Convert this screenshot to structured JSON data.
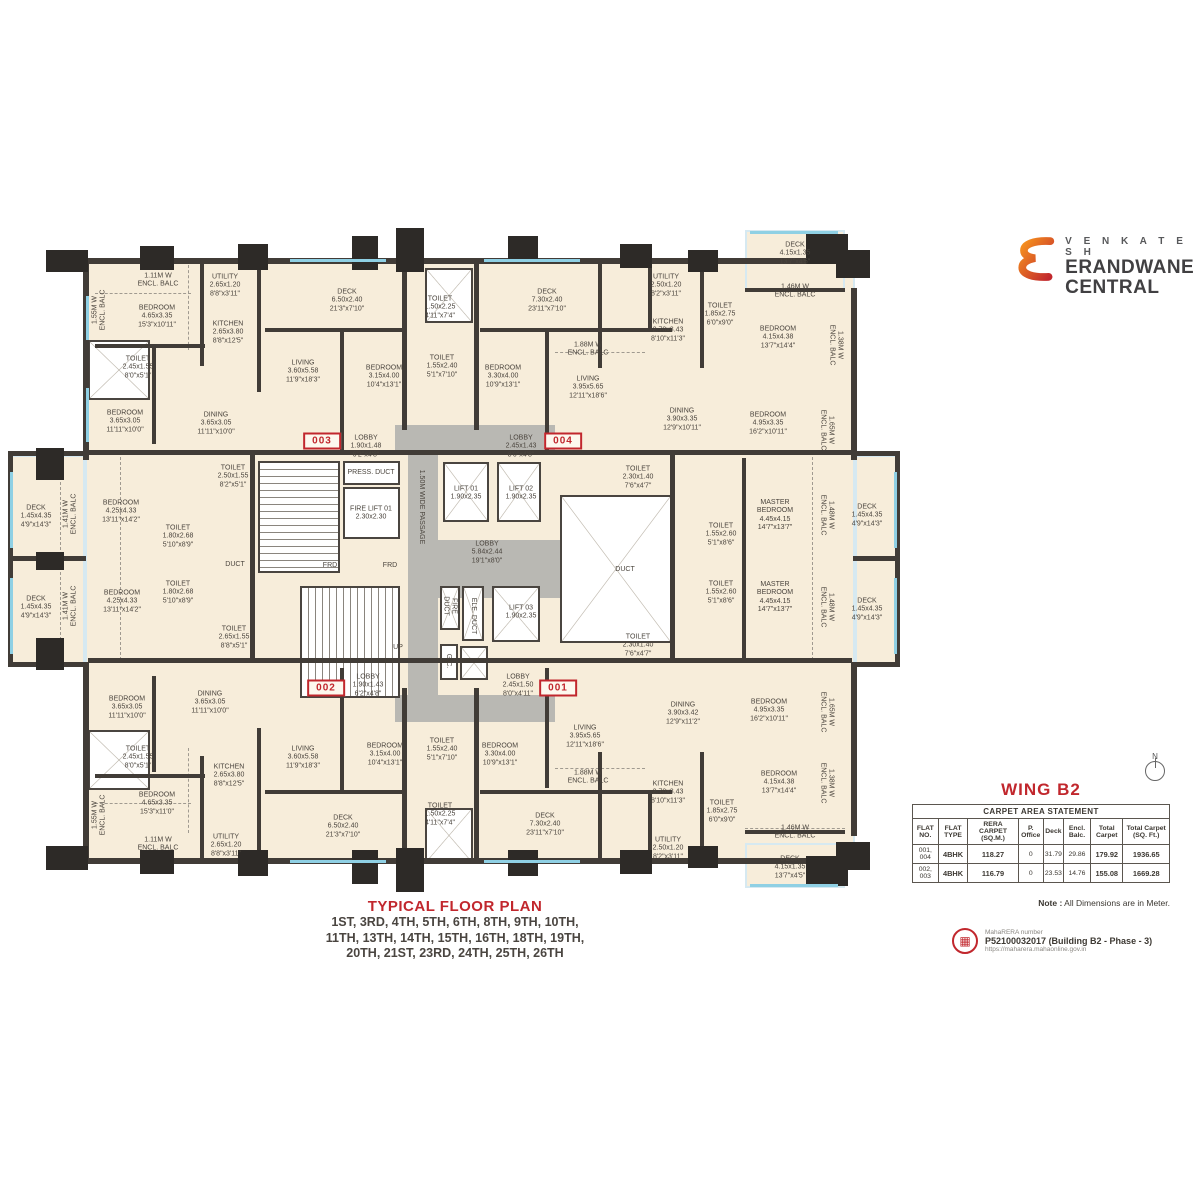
{
  "logo": {
    "brand_top": "V E N K A T E S H",
    "brand_mid": "ERANDWANE",
    "brand_bot": "CENTRAL"
  },
  "title_block": {
    "title": "TYPICAL FLOOR PLAN",
    "floors_line1": "1ST, 3RD, 4TH, 5TH, 6TH, 8TH, 9TH, 10TH,",
    "floors_line2": "11TH, 13TH, 14TH, 15TH, 16TH, 18TH, 19TH,",
    "floors_line3": "20TH, 21ST, 23RD, 24TH, 25TH, 26TH"
  },
  "panel": {
    "wing_title": "WING B2",
    "table": {
      "title": "CARPET AREA STATEMENT",
      "headers": [
        "FLAT NO.",
        "FLAT TYPE",
        "RERA CARPET (SQ.M.)",
        "P. Office",
        "Deck",
        "Encl. Balc.",
        "Total Carpet",
        "Total Carpet (SQ. Ft.)"
      ],
      "rows": [
        [
          "001, 004",
          "4BHK",
          "118.27",
          "0",
          "31.79",
          "29.86",
          "179.92",
          "1936.65"
        ],
        [
          "002, 003",
          "4BHK",
          "116.79",
          "0",
          "23.53",
          "14.76",
          "155.08",
          "1669.28"
        ]
      ]
    },
    "note_label": "Note :",
    "note_text": " All Dimensions are in Meter.",
    "rera_label": "MahaRERA number",
    "rera_number": "P52100032017 (Building B2 - Phase - 3)",
    "rera_url": "https://maharera.mahaonline.gov.in",
    "north_label": "N"
  },
  "colors": {
    "accent_red": "#c1272d",
    "wall": "#413c37",
    "plan_beige": "#f7edda",
    "core_gray": "#b9b8b3",
    "window_blue": "#8fd0e4"
  },
  "plan": {
    "units": [
      {
        "id": "003",
        "x": 322,
        "y": 441
      },
      {
        "id": "004",
        "x": 563,
        "y": 441
      },
      {
        "id": "002",
        "x": 326,
        "y": 688
      },
      {
        "id": "001",
        "x": 558,
        "y": 688
      }
    ],
    "rooms": [
      {
        "t": "1.55M W\nENCL. BALC",
        "x": 100,
        "y": 310,
        "v": 1
      },
      {
        "t": "1.11M W\nENCL. BALC",
        "x": 158,
        "y": 281
      },
      {
        "t": "BEDROOM\n4.65x3.35\n15'3\"x10'11\"",
        "x": 157,
        "y": 317
      },
      {
        "t": "UTILITY\n2.65x1.20\n8'8\"x3'11\"",
        "x": 225,
        "y": 286
      },
      {
        "t": "KITCHEN\n2.65x3.80\n8'8\"x12'5\"",
        "x": 228,
        "y": 333
      },
      {
        "t": "TOILET\n2.45x1.55\n8'0\"x5'1\"",
        "x": 138,
        "y": 368
      },
      {
        "t": "BEDROOM\n3.65x3.05\n11'11\"x10'0\"",
        "x": 125,
        "y": 422
      },
      {
        "t": "DINING\n3.65x3.05\n11'11\"x10'0\"",
        "x": 216,
        "y": 424
      },
      {
        "t": "LIVING\n3.60x5.58\n11'9\"x18'3\"",
        "x": 303,
        "y": 372
      },
      {
        "t": "DECK\n6.50x2.40\n21'3\"x7'10\"",
        "x": 347,
        "y": 301
      },
      {
        "t": "TOILET\n1.50x2.25\n4'11\"x7'4\"",
        "x": 440,
        "y": 308
      },
      {
        "t": "TOILET\n1.55x2.40\n5'1\"x7'10\"",
        "x": 442,
        "y": 367
      },
      {
        "t": "BEDROOM\n3.15x4.00\n10'4\"x13'1\"",
        "x": 384,
        "y": 377
      },
      {
        "t": "BEDROOM\n3.30x4.00\n10'9\"x13'1\"",
        "x": 503,
        "y": 377
      },
      {
        "t": "DECK\n7.30x2.40\n23'11\"x7'10\"",
        "x": 547,
        "y": 301
      },
      {
        "t": "LOBBY\n1.90x1.48\n6'2\"x4'8\"",
        "x": 366,
        "y": 447
      },
      {
        "t": "LOBBY\n2.45x1.43\n8'0\"x4'8\"",
        "x": 521,
        "y": 447
      },
      {
        "t": "UTILITY\n2.50x1.20\n8'2\"x3'11\"",
        "x": 666,
        "y": 286
      },
      {
        "t": "TOILET\n1.85x2.75\n6'0\"x9'0\"",
        "x": 720,
        "y": 315
      },
      {
        "t": "KITCHEN\n2.70x3.43\n8'10\"x11'3\"",
        "x": 668,
        "y": 331
      },
      {
        "t": "1.88M W\nENCL. BALC",
        "x": 588,
        "y": 350
      },
      {
        "t": "LIVING\n3.95x5.65\n12'11\"x18'6\"",
        "x": 588,
        "y": 388
      },
      {
        "t": "DINING\n3.90x3.35\n12'9\"x10'11\"",
        "x": 682,
        "y": 420
      },
      {
        "t": "BEDROOM\n4.15x4.38\n13'7\"x14'4\"",
        "x": 778,
        "y": 338
      },
      {
        "t": "BEDROOM\n4.95x3.35\n16'2\"x10'11\"",
        "x": 768,
        "y": 424
      },
      {
        "t": "DECK\n4.15x1.35\n13'7\"x4'5\"",
        "x": 795,
        "y": 254
      },
      {
        "t": "1.46M W\nENCL. BALC",
        "x": 795,
        "y": 292
      },
      {
        "t": "1.38M W\nENCL. BALC",
        "x": 835,
        "y": 345,
        "v": 2
      },
      {
        "t": "1.65M W\nENCL. BALC",
        "x": 826,
        "y": 430,
        "v": 2
      },
      {
        "t": "DECK\n1.45x4.35\n4'9\"x14'3\"",
        "x": 36,
        "y": 517
      },
      {
        "t": "1.41M W\nENCL. BALC",
        "x": 71,
        "y": 514,
        "v": 1
      },
      {
        "t": "BEDROOM\n4.25x4.33\n13'11\"x14'2\"",
        "x": 121,
        "y": 512
      },
      {
        "t": "TOILET\n2.50x1.55\n8'2\"x5'1\"",
        "x": 233,
        "y": 477
      },
      {
        "t": "TOILET\n1.80x2.68\n5'10\"x8'9\"",
        "x": 178,
        "y": 537
      },
      {
        "t": "DUCT",
        "x": 235,
        "y": 565
      },
      {
        "t": "TOILET\n1.80x2.68\n5'10\"x8'9\"",
        "x": 178,
        "y": 593
      },
      {
        "t": "DECK\n1.45x4.35\n4'9\"x14'3\"",
        "x": 36,
        "y": 608
      },
      {
        "t": "1.41M W\nENCL. BALC",
        "x": 71,
        "y": 606,
        "v": 1
      },
      {
        "t": "BEDROOM\n4.25x4.33\n13'11\"x14'2\"",
        "x": 122,
        "y": 602
      },
      {
        "t": "TOILET\n2.65x1.55\n8'8\"x5'1\"",
        "x": 234,
        "y": 638
      },
      {
        "t": "PRESS. DUCT",
        "x": 371,
        "y": 473
      },
      {
        "t": "FIRE LIFT 01\n2.30x2.30",
        "x": 371,
        "y": 514
      },
      {
        "t": "FRD",
        "x": 330,
        "y": 566
      },
      {
        "t": "FRD",
        "x": 390,
        "y": 566
      },
      {
        "t": "1.50M WIDE PASSAGE",
        "x": 421,
        "y": 507,
        "v": 2
      },
      {
        "t": "LIFT 01\n1.90x2.35",
        "x": 466,
        "y": 494
      },
      {
        "t": "LIFT 02\n1.90x2.35",
        "x": 521,
        "y": 494
      },
      {
        "t": "LOBBY\n5.84x2.44\n19'1\"x8'0\"",
        "x": 487,
        "y": 553
      },
      {
        "t": "FIRE\nDUCT",
        "x": 449,
        "y": 606,
        "v": 2
      },
      {
        "t": "ELE. DUCT",
        "x": 473,
        "y": 616,
        "v": 2
      },
      {
        "t": "LIFT 03\n1.90x2.35",
        "x": 521,
        "y": 613
      },
      {
        "t": "G.C.",
        "x": 448,
        "y": 661,
        "v": 2
      },
      {
        "t": "UP",
        "x": 398,
        "y": 648
      },
      {
        "t": "DUCT",
        "x": 625,
        "y": 570
      },
      {
        "t": "TOILET\n2.30x1.40\n7'6\"x4'7\"",
        "x": 638,
        "y": 478
      },
      {
        "t": "TOILET\n1.55x2.60\n5'1\"x8'6\"",
        "x": 721,
        "y": 535
      },
      {
        "t": "TOILET\n1.55x2.60\n5'1\"x8'6\"",
        "x": 721,
        "y": 593
      },
      {
        "t": "TOILET\n2.30x1.40\n7'6\"x4'7\"",
        "x": 638,
        "y": 646
      },
      {
        "t": "MASTER\nBEDROOM\n4.45x4.15\n14'7\"x13'7\"",
        "x": 775,
        "y": 516
      },
      {
        "t": "MASTER\nBEDROOM\n4.45x4.15\n14'7\"x13'7\"",
        "x": 775,
        "y": 598
      },
      {
        "t": "1.48M W\nENCL. BALC",
        "x": 826,
        "y": 515,
        "v": 2
      },
      {
        "t": "DECK\n1.45x4.35\n4'9\"x14'3\"",
        "x": 867,
        "y": 516
      },
      {
        "t": "1.48M W\nENCL. BALC",
        "x": 826,
        "y": 607,
        "v": 2
      },
      {
        "t": "DECK\n1.45x4.35\n4'9\"x14'3\"",
        "x": 867,
        "y": 610
      },
      {
        "t": "LOBBY\n1.90x1.43\n6'2\"x4'8\"",
        "x": 368,
        "y": 686
      },
      {
        "t": "LOBBY\n2.45x1.50\n8'0\"x4'11\"",
        "x": 518,
        "y": 686
      },
      {
        "t": "BEDROOM\n3.15x4.00\n10'4\"x13'1\"",
        "x": 385,
        "y": 755
      },
      {
        "t": "TOILET\n1.55x2.40\n5'1\"x7'10\"",
        "x": 442,
        "y": 750
      },
      {
        "t": "BEDROOM\n3.30x4.00\n10'9\"x13'1\"",
        "x": 500,
        "y": 755
      },
      {
        "t": "TOILET\n1.50x2.25\n4'11\"x7'4\"",
        "x": 440,
        "y": 815
      },
      {
        "t": "DECK\n6.50x2.40\n21'3\"x7'10\"",
        "x": 343,
        "y": 827
      },
      {
        "t": "DECK\n7.30x2.40\n23'11\"x7'10\"",
        "x": 545,
        "y": 825
      },
      {
        "t": "BEDROOM\n3.65x3.05\n11'11\"x10'0\"",
        "x": 127,
        "y": 708
      },
      {
        "t": "DINING\n3.65x3.05\n11'11\"x10'0\"",
        "x": 210,
        "y": 703
      },
      {
        "t": "TOILET\n2.45x1.55\n8'0\"x5'1\"",
        "x": 138,
        "y": 758
      },
      {
        "t": "BEDROOM\n4.65x3.35\n15'3\"x11'0\"",
        "x": 157,
        "y": 804
      },
      {
        "t": "1.55M W\nENCL. BALC",
        "x": 100,
        "y": 815,
        "v": 1
      },
      {
        "t": "1.11M W\nENCL. BALC",
        "x": 158,
        "y": 845
      },
      {
        "t": "KITCHEN\n2.65x3.80\n8'8\"x12'5\"",
        "x": 229,
        "y": 776
      },
      {
        "t": "UTILITY\n2.65x1.20\n8'8\"x3'11\"",
        "x": 226,
        "y": 846
      },
      {
        "t": "LIVING\n3.60x5.58\n11'9\"x18'3\"",
        "x": 303,
        "y": 758
      },
      {
        "t": "DINING\n3.90x3.42\n12'9\"x11'2\"",
        "x": 683,
        "y": 714
      },
      {
        "t": "LIVING\n3.95x5.65\n12'11\"x18'6\"",
        "x": 585,
        "y": 737
      },
      {
        "t": "1.88M W\nENCL. BALC",
        "x": 588,
        "y": 778
      },
      {
        "t": "KITCHEN\n2.70x3.43\n8'10\"x11'3\"",
        "x": 668,
        "y": 793
      },
      {
        "t": "TOILET\n1.85x2.75\n6'0\"x9'0\"",
        "x": 722,
        "y": 812
      },
      {
        "t": "UTILITY\n2.50x1.20\n8'2\"x3'11\"",
        "x": 668,
        "y": 849
      },
      {
        "t": "BEDROOM\n4.95x3.35\n16'2\"x10'11\"",
        "x": 769,
        "y": 711
      },
      {
        "t": "BEDROOM\n4.15x4.38\n13'7\"x14'4\"",
        "x": 779,
        "y": 783
      },
      {
        "t": "1.46M W\nENCL. BALC",
        "x": 795,
        "y": 833
      },
      {
        "t": "DECK\n4.15x1.35\n13'7\"x4'5\"",
        "x": 790,
        "y": 868
      },
      {
        "t": "1.65M W\nENCL. BALC",
        "x": 826,
        "y": 712,
        "v": 2
      },
      {
        "t": "1.38M W\nENCL. BALC",
        "x": 826,
        "y": 783,
        "v": 2
      }
    ]
  }
}
